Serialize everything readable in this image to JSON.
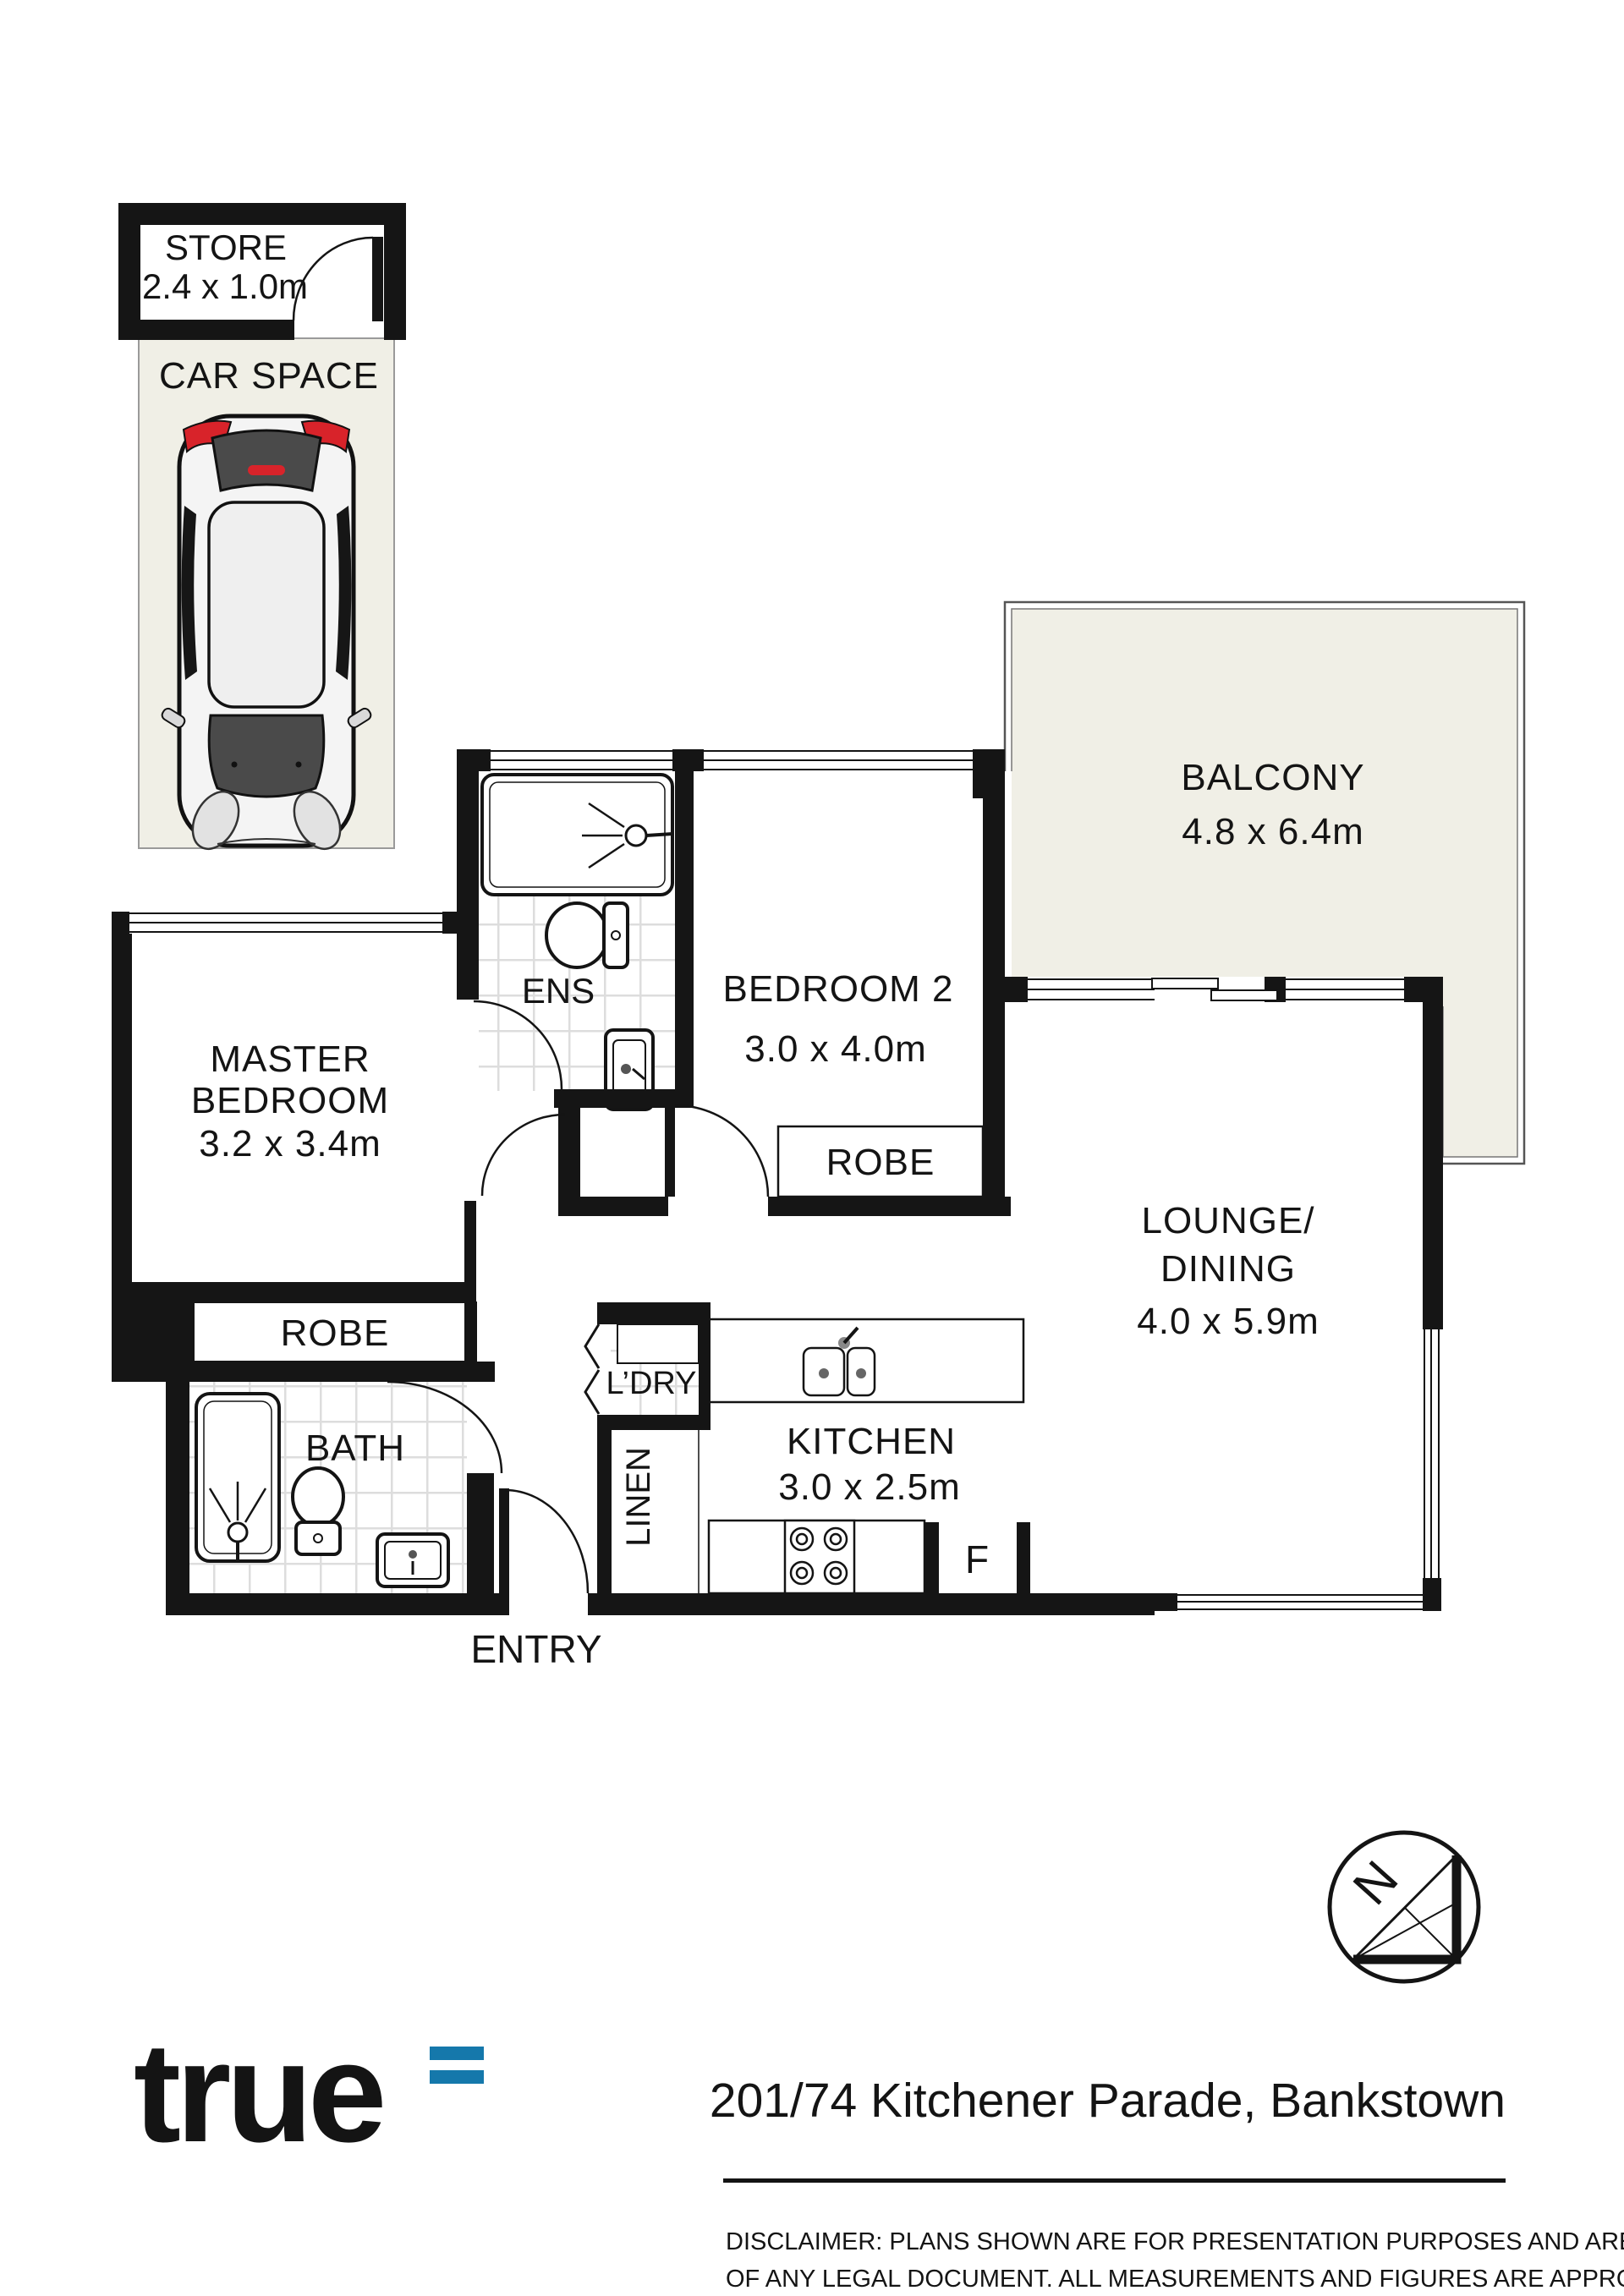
{
  "plan": {
    "rooms": {
      "store": {
        "name": "STORE",
        "dims": "2.4 x 1.0m"
      },
      "car_space": {
        "name": "CAR SPACE"
      },
      "balcony": {
        "name": "BALCONY",
        "dims": "4.8 x 6.4m"
      },
      "ens": {
        "name": "ENS"
      },
      "bedroom2": {
        "name": "BEDROOM 2",
        "dims": "3.0 x 4.0m"
      },
      "master": {
        "line1": "MASTER",
        "line2": "BEDROOM",
        "dims": "3.2 x 3.4m"
      },
      "robe_master": {
        "name": "ROBE"
      },
      "robe_bedroom2": {
        "name": "ROBE"
      },
      "lounge": {
        "line1": "LOUNGE/",
        "line2": "DINING",
        "dims": "4.0 x 5.9m"
      },
      "kitchen": {
        "name": "KITCHEN",
        "dims": "3.0 x 2.5m"
      },
      "laundry": {
        "name": "L’DRY"
      },
      "linen": {
        "name": "LINEN"
      },
      "bath": {
        "name": "BATH"
      },
      "entry": {
        "name": "ENTRY"
      },
      "fridge": {
        "label": "F"
      }
    },
    "compass": {
      "north_label": "N"
    }
  },
  "footer": {
    "logo_text": "true",
    "address": "201/74 Kitchener Parade, Bankstown",
    "disclaimer_line1": "DISCLAIMER:  PLANS SHOWN ARE FOR PRESENTATION PURPOSES AND ARE NOT PART",
    "disclaimer_line2": "OF ANY LEGAL DOCUMENT. ALL MEASUREMENTS AND FIGURES ARE APPROXIMATE."
  },
  "colors": {
    "wall": "#151515",
    "floor_fill": "#f0efe6",
    "tile_line": "#dddddd",
    "logo_blue": "#1578ab",
    "accent_red": "#d8232a"
  }
}
